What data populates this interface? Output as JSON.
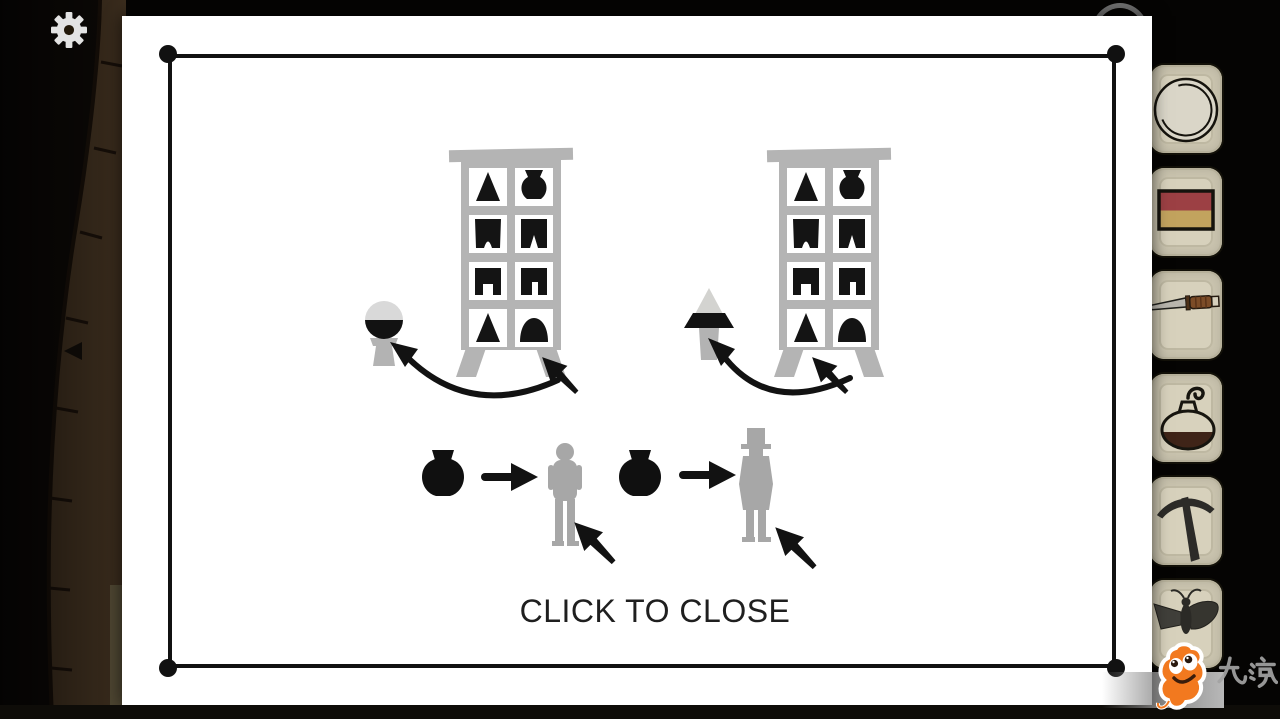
{
  "app": {
    "title": "puzzle-hint-note"
  },
  "colors": {
    "card": "#ffffff",
    "ink": "#121212",
    "cabinet_gray": "#b4b4b4",
    "figure_gray": "#a7a7a7",
    "slot_beige": "#cdc7b2",
    "stone_brown": "#3a2c1d",
    "mascot_orange": "#f57b1d",
    "matchbox_red": "#9c4044",
    "matchbox_tan": "#c2a35e"
  },
  "hud": {
    "settings_icon": "gear",
    "back_icon": "left-triangle"
  },
  "note": {
    "close_label": "CLICK TO CLOSE",
    "cabinets": [
      {
        "side": "left",
        "cells": [
          "triangle",
          "vase",
          "arch-notch",
          "peak-notch",
          "square-notch",
          "slot-notch",
          "triangle",
          "dome"
        ],
        "arrow_points_to": "dome-cell",
        "produces": "sphere-top-bottle"
      },
      {
        "side": "right",
        "cells": [
          "triangle",
          "vase",
          "arch-notch",
          "peak-notch",
          "square-notch",
          "slot-notch",
          "triangle",
          "dome"
        ],
        "arrow_points_to": "triangle-cell",
        "produces": "cone-top-bottle"
      }
    ],
    "mappings": [
      {
        "give": "black-vase",
        "to": "boy-figure"
      },
      {
        "give": "black-vase",
        "to": "top-hat-man-figure"
      }
    ]
  },
  "inventory": {
    "items": [
      {
        "name": "plate"
      },
      {
        "name": "matchbox"
      },
      {
        "name": "knife"
      },
      {
        "name": "round-flask"
      },
      {
        "name": "pickaxe"
      },
      {
        "name": "moth"
      }
    ]
  },
  "watermark": {
    "text": "九游"
  }
}
